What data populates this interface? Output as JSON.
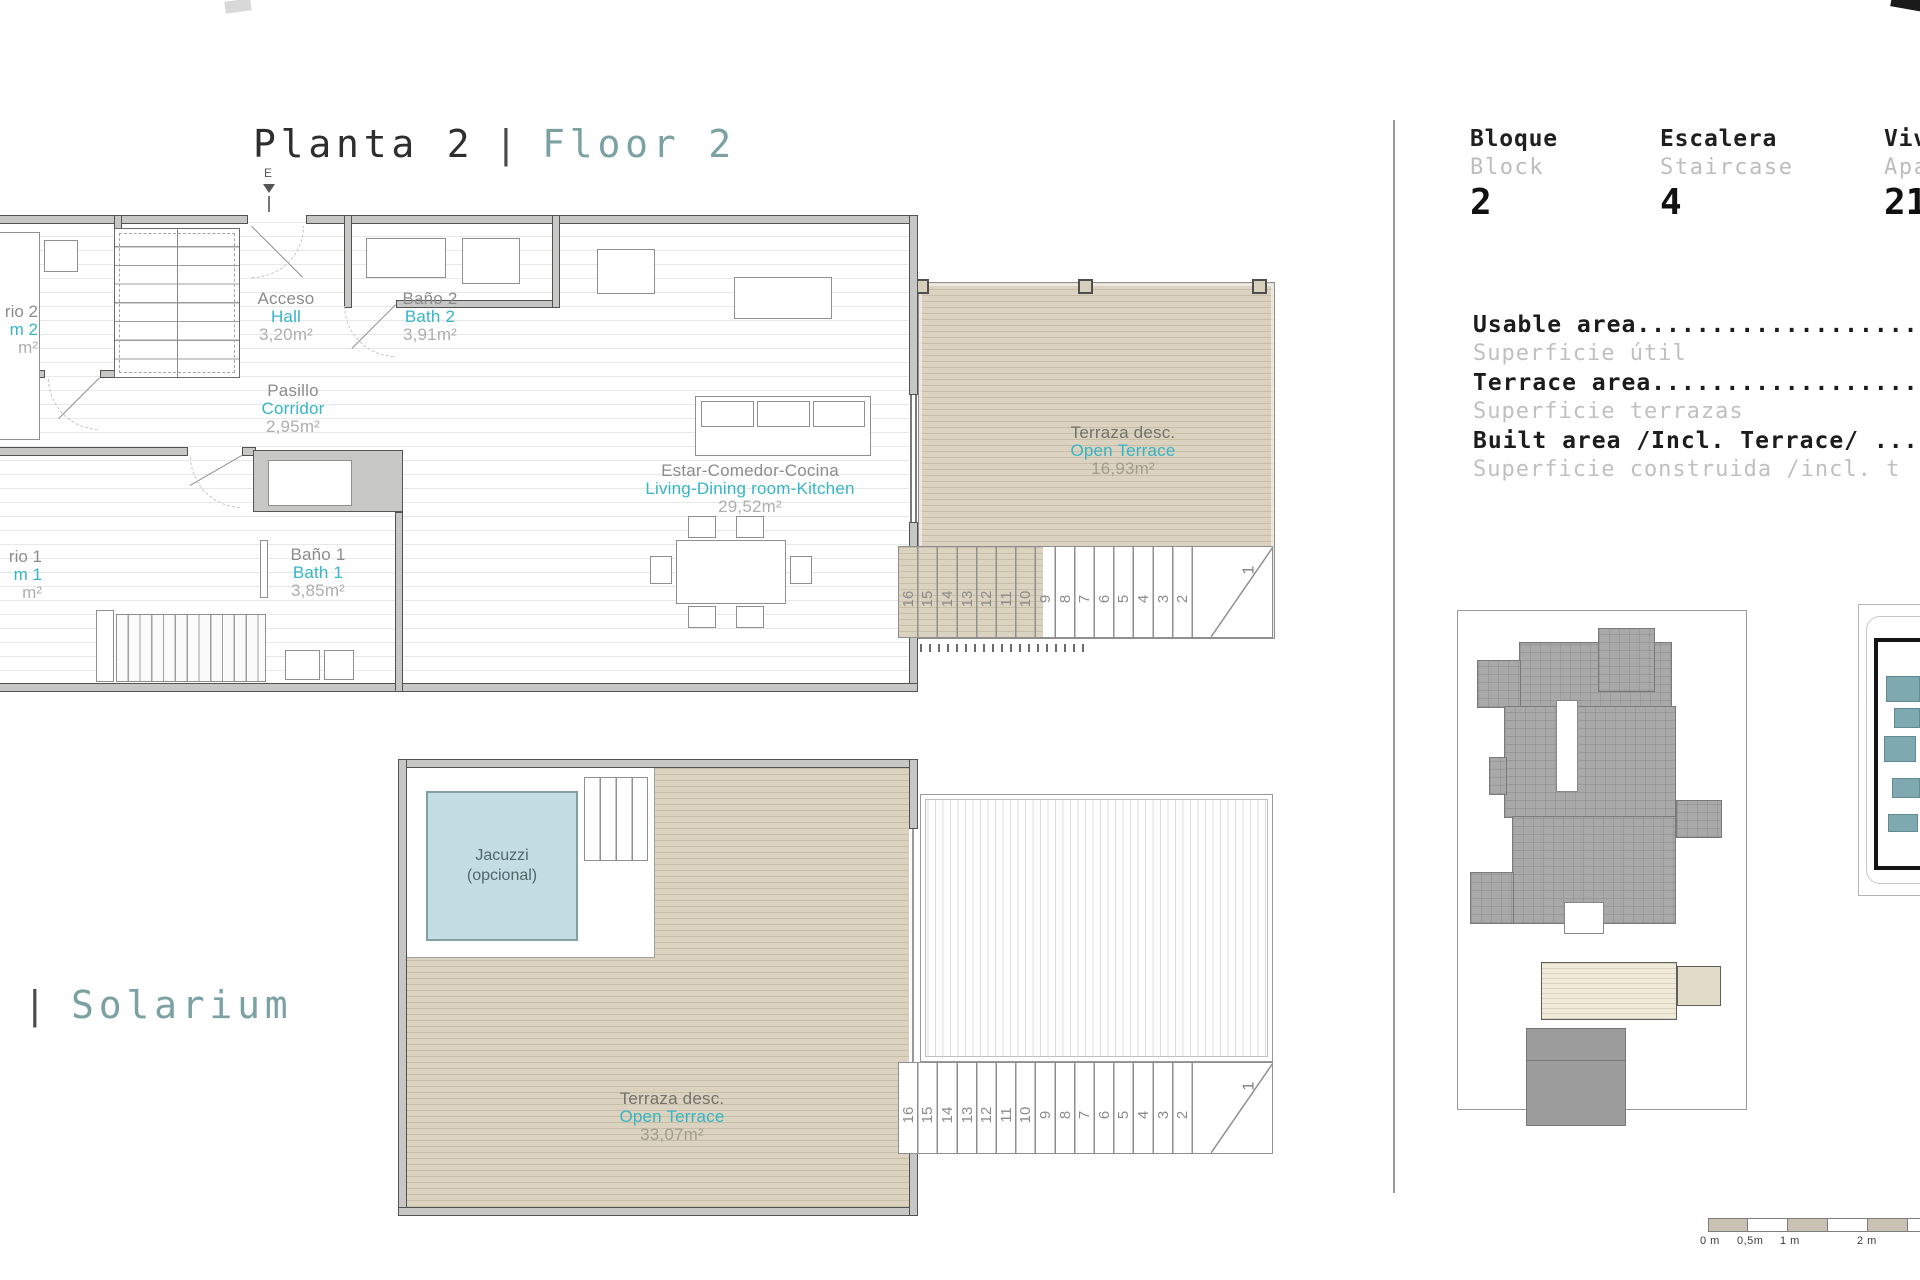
{
  "floor_title": {
    "es": "Planta 2",
    "divider": "|",
    "en": "Floor 2"
  },
  "solarium_title": {
    "es_cut": "um",
    "divider": "|",
    "en": "Solarium"
  },
  "entrance_label": "E",
  "upper_rooms": {
    "acceso": {
      "es": "Acceso",
      "en": "Hall",
      "area": "3,20m²"
    },
    "bano2": {
      "es": "Baño 2",
      "en": "Bath 2",
      "area": "3,91m²"
    },
    "pasillo": {
      "es": "Pasillo",
      "en": "Corridor",
      "area": "2,95m²"
    },
    "bano1": {
      "es": "Baño 1",
      "en": "Bath 1",
      "area": "3,85m²"
    },
    "living": {
      "es": "Estar-Comedor-Cocina",
      "en": "Living-Dining room-Kitchen",
      "area": "29,52m²"
    },
    "terrace": {
      "es": "Terraza desc.",
      "en": "Open Terrace",
      "area": "16,93m²"
    },
    "dorm2_cut": {
      "es": "rio 2",
      "en": "m 2",
      "area": "m²"
    },
    "dorm1_cut": {
      "es": "rio 1",
      "en": "m 1",
      "area": "m²"
    }
  },
  "solarium": {
    "jacuzzi_line1": "Jacuzzi",
    "jacuzzi_line2": "(opcional)",
    "terrace": {
      "es": "Terraza desc.",
      "en": "Open Terrace",
      "area": "33,07m²"
    }
  },
  "stairs": {
    "numbers": [
      "16",
      "15",
      "14",
      "13",
      "12",
      "11",
      "10",
      "9",
      "8",
      "7",
      "6",
      "5",
      "4",
      "3",
      "2"
    ],
    "last": "1"
  },
  "info": {
    "columns": [
      {
        "es": "Bloque",
        "en": "Block",
        "value": "2"
      },
      {
        "es": "Escalera",
        "en": "Staircase",
        "value": "4"
      },
      {
        "es": "Viv",
        "en": "Apa",
        "value": "21"
      }
    ],
    "areas": [
      {
        "en": "Usable area...............................",
        "es": "Superficie útil"
      },
      {
        "en": "Terrace area..............................",
        "es": "Superficie terrazas"
      },
      {
        "en": "Built area /Incl. Terrace/ ...............",
        "es": "Superficie construida /incl. t"
      }
    ]
  },
  "scale": {
    "labels": [
      "0 m",
      "0,5m",
      "1 m",
      "2 m"
    ]
  },
  "colors": {
    "teal_title": "#7ba1a2",
    "teal_label": "#35b5c6",
    "gray_label": "#8c8c8c",
    "terrace_fill": "#dbd3c0",
    "jacuzzi_fill": "#c3dde2"
  }
}
